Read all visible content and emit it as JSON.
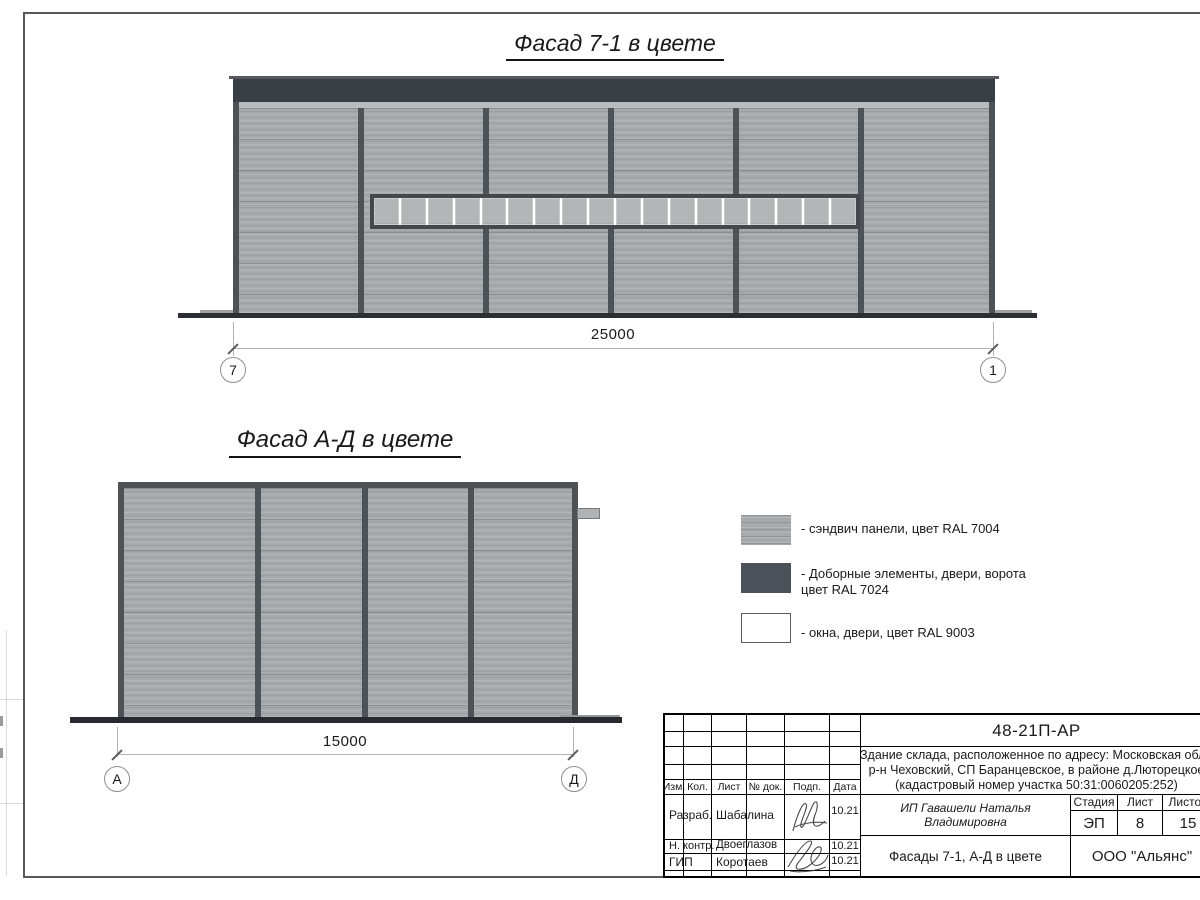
{
  "sheet": {
    "facade_top": {
      "title": "Фасад 7-1 в цвете",
      "dimension": "25000",
      "axis_left": "7",
      "axis_right": "1",
      "window_pane_count": 18
    },
    "facade_side": {
      "title": "Фасад А-Д в цвете",
      "dimension": "15000",
      "axis_left": "А",
      "axis_right": "Д"
    },
    "legend": {
      "item1": {
        "label": "- сэндвич панели, цвет RAL 7004",
        "color": "#a7aaac"
      },
      "item2": {
        "line1": "- Доборные элементы, двери, ворота",
        "line2": "цвет RAL 7024",
        "color": "#4b525a"
      },
      "item3": {
        "label": "- окна, двери, цвет RAL 9003",
        "color": "#ffffff"
      }
    },
    "colors": {
      "sandwich_panel": "#a7aaac",
      "trim_dark": "#4d5257",
      "parapet": "#393e44",
      "window_white": "#ffffff",
      "ground": "#2b2f33"
    },
    "title_block": {
      "doc_number": "48-21П-АР",
      "address_line1": "Здание склада, расположенное по адресу: Московская область,",
      "address_line2": "р-н Чеховский, СП Баранцевское, в районе д.Люторецкое",
      "address_line3": "(кадастровый номер участка 50:31:0060205:252)",
      "columns": {
        "izm": "Изм.",
        "kol": "Кол.",
        "list": "Лист",
        "doc": "№ док.",
        "podp": "Подп.",
        "data": "Дата"
      },
      "rows": [
        {
          "role": "Разраб.",
          "name": "Шабалина",
          "date": "10.21"
        },
        {
          "role": "Н. контр.",
          "name": "Двоеглазов",
          "date": "10.21"
        },
        {
          "role": "ГИП",
          "name": "Коротаев",
          "date": "10.21"
        }
      ],
      "client": "ИП Гавашели Наталья Владимировна",
      "stage_label": "Стадия",
      "stage": "ЭП",
      "sheet_label": "Лист",
      "sheet_number": "8",
      "sheets_label": "Листов",
      "sheets_total": "15",
      "drawing_title": "Фасады 7-1, А-Д в цвете",
      "company": "ООО \"Альянс\""
    }
  }
}
